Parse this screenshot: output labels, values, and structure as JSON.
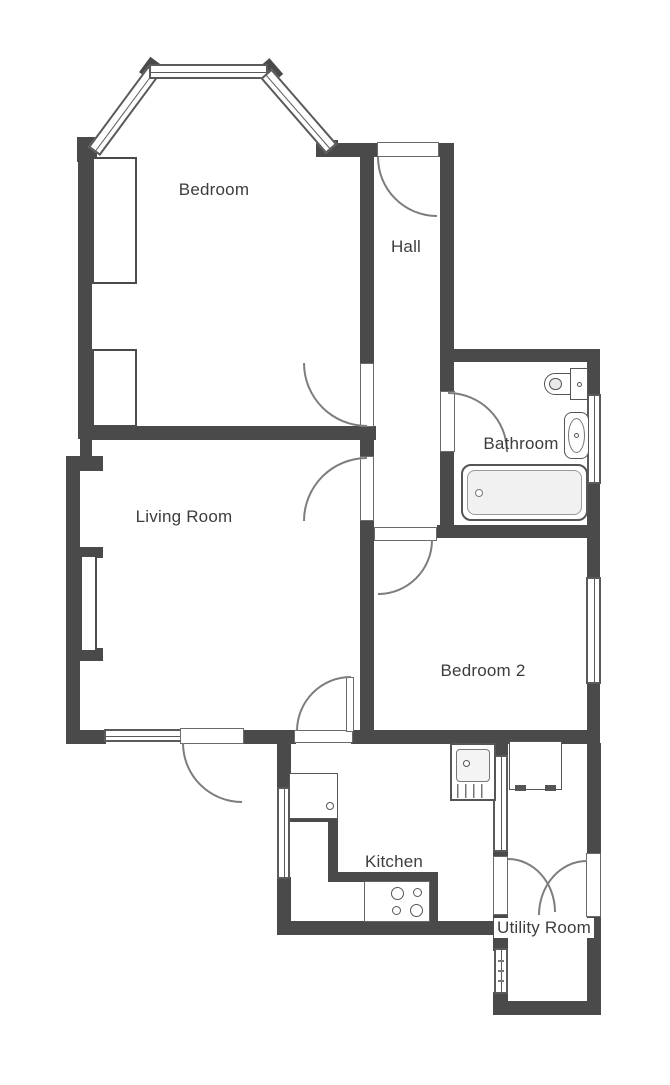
{
  "plan": {
    "rooms": [
      {
        "id": "bedroom",
        "label": "Bedroom"
      },
      {
        "id": "hall",
        "label": "Hall"
      },
      {
        "id": "bathroom",
        "label": "Bathroom"
      },
      {
        "id": "living-room",
        "label": "Living Room"
      },
      {
        "id": "bedroom-2",
        "label": "Bedroom 2"
      },
      {
        "id": "kitchen",
        "label": "Kitchen"
      },
      {
        "id": "utility-room",
        "label": "Utility Room"
      }
    ],
    "fixtures": [
      "bay-window",
      "built-in-wardrobe",
      "fireplace-recess",
      "toilet",
      "basin",
      "bath",
      "kitchen-sink",
      "hob",
      "worktop",
      "kitchen-appliance",
      "utility-appliance"
    ],
    "colors": {
      "wall": "#4a4a4a",
      "fixture_line": "#555555",
      "door_arc": "#7d7d7d",
      "text": "#3d3d3d",
      "bath_fill": "#f1f1f1"
    }
  }
}
